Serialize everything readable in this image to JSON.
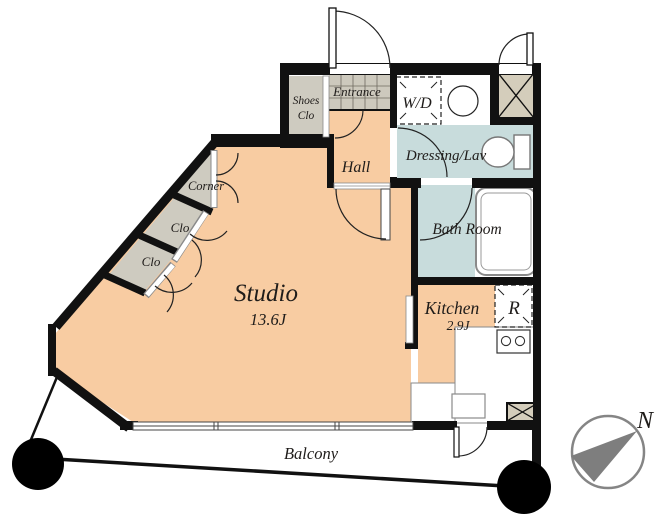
{
  "labels": {
    "studio": "Studio",
    "studio_size": "13.6J",
    "kitchen": "Kitchen",
    "kitchen_size": "2.9J",
    "bath": "Bath Room",
    "dressing": "Dressing/Lav",
    "hall": "Hall",
    "entrance": "Entrance",
    "shoes_line1": "Shoes",
    "shoes_line2": "Clo",
    "corner_closet": "Corner",
    "closet_upper": "Clo",
    "closet_lower": "Clo",
    "washer_dryer": "W/D",
    "refrigerator": "R",
    "balcony": "Balcony",
    "north": "N"
  },
  "colors": {
    "floor": "#F8CCA2",
    "wet": "#C8DCDC",
    "closet": "#CECBC0",
    "tile": "#CDC9BD",
    "shaft": "#D4CDBB",
    "wall": "#111111",
    "compass": "#858585"
  }
}
